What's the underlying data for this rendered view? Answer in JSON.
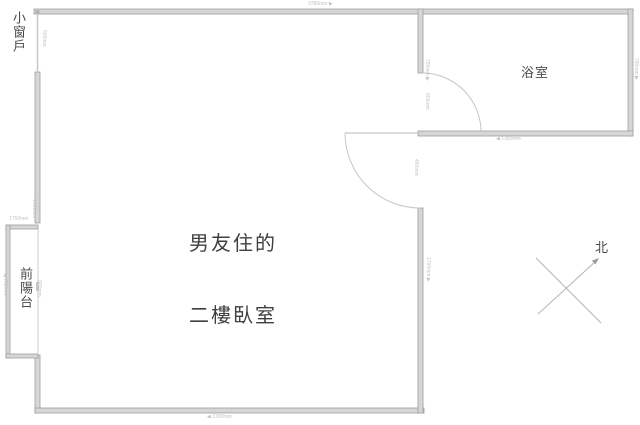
{
  "title": "二樓平面圖",
  "rooms": {
    "bedroom_line1": "男友住的",
    "bedroom_line2": "二樓臥室",
    "bathroom": "浴室",
    "balcony": "前陽台",
    "small_window": "小窗戶"
  },
  "compass": {
    "north": "北"
  },
  "dimensions": {
    "top_wall": "3780mm ▶",
    "bottom_wall": "◀ 2300mm",
    "window_height": "500mm",
    "left_wall_mid": "1500mm",
    "balcony_top": "1750mm",
    "balcony_left": "◀ 780mm",
    "balcony_inner": "900mm",
    "divider_upper": "750mm ▶",
    "divider_opening": "600mm",
    "door_opening": "450mm",
    "bedroom_right_wall": "1700mm ▶",
    "bathroom_right_wall": "780mm ▶",
    "bathroom_bottom": "◀ 1380mm"
  },
  "colors": {
    "wall_fill": "#d6d6d6",
    "wall_stroke": "#9e9e9e",
    "thin_line": "#c6c6c6",
    "text": "#4a4a4a",
    "dim_text": "#c3c3c3"
  }
}
